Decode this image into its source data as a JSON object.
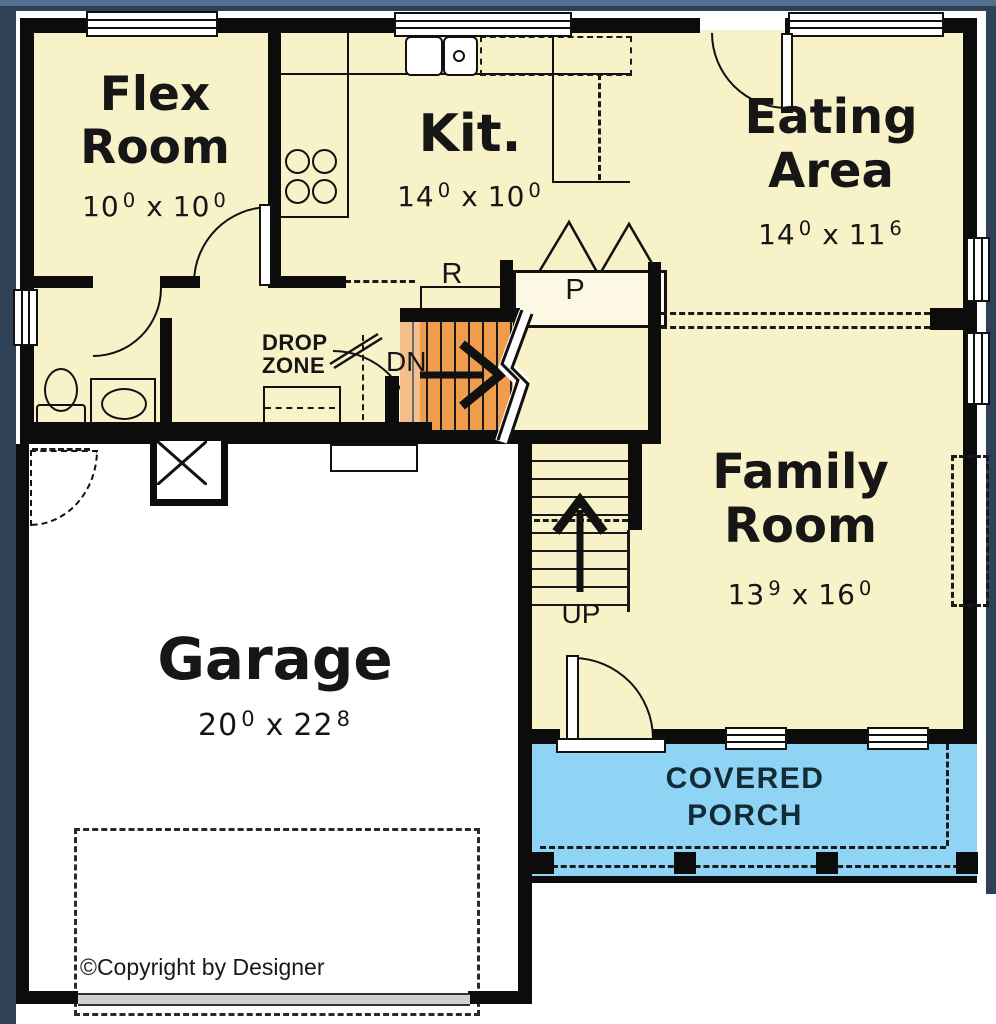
{
  "plan": {
    "rooms": {
      "flex_room": {
        "name": [
          "Flex",
          "Room"
        ],
        "dim": {
          "a": "10",
          "a_sup": "0",
          "sep": "x",
          "b": "10",
          "b_sup": "0"
        }
      },
      "kitchen": {
        "name": [
          "Kit."
        ],
        "dim": {
          "a": "14",
          "a_sup": "0",
          "sep": "x",
          "b": "10",
          "b_sup": "0"
        }
      },
      "eating_area": {
        "name": [
          "Eating",
          "Area"
        ],
        "dim": {
          "a": "14",
          "a_sup": "0",
          "sep": "x",
          "b": "11",
          "b_sup": "6"
        }
      },
      "family_room": {
        "name": [
          "Family",
          "Room"
        ],
        "dim": {
          "a": "13",
          "a_sup": "9",
          "sep": "x",
          "b": "16",
          "b_sup": "0"
        }
      },
      "garage": {
        "name": [
          "Garage"
        ],
        "dim": {
          "a": "20",
          "a_sup": "0",
          "sep": "x",
          "b": "22",
          "b_sup": "8"
        }
      },
      "covered_porch": {
        "name": [
          "COVERED",
          "PORCH"
        ]
      }
    },
    "annotations": {
      "drop_zone": [
        "DROP",
        "ZONE"
      ],
      "refrigerator": "R",
      "pantry": "P",
      "stairs_down": "DN",
      "stairs_up": "UP",
      "copyright": "©Copyright by Designer"
    },
    "colors": {
      "frame_background": "#2E4156",
      "frame_highlight": "#52708F",
      "room_fill": "#F7F2C8",
      "garage_fill": "#FFFFFF",
      "porch_fill": "#8FD3F5",
      "stair_highlight": "#EF9D4B",
      "wall": "#0C0C0C"
    }
  }
}
